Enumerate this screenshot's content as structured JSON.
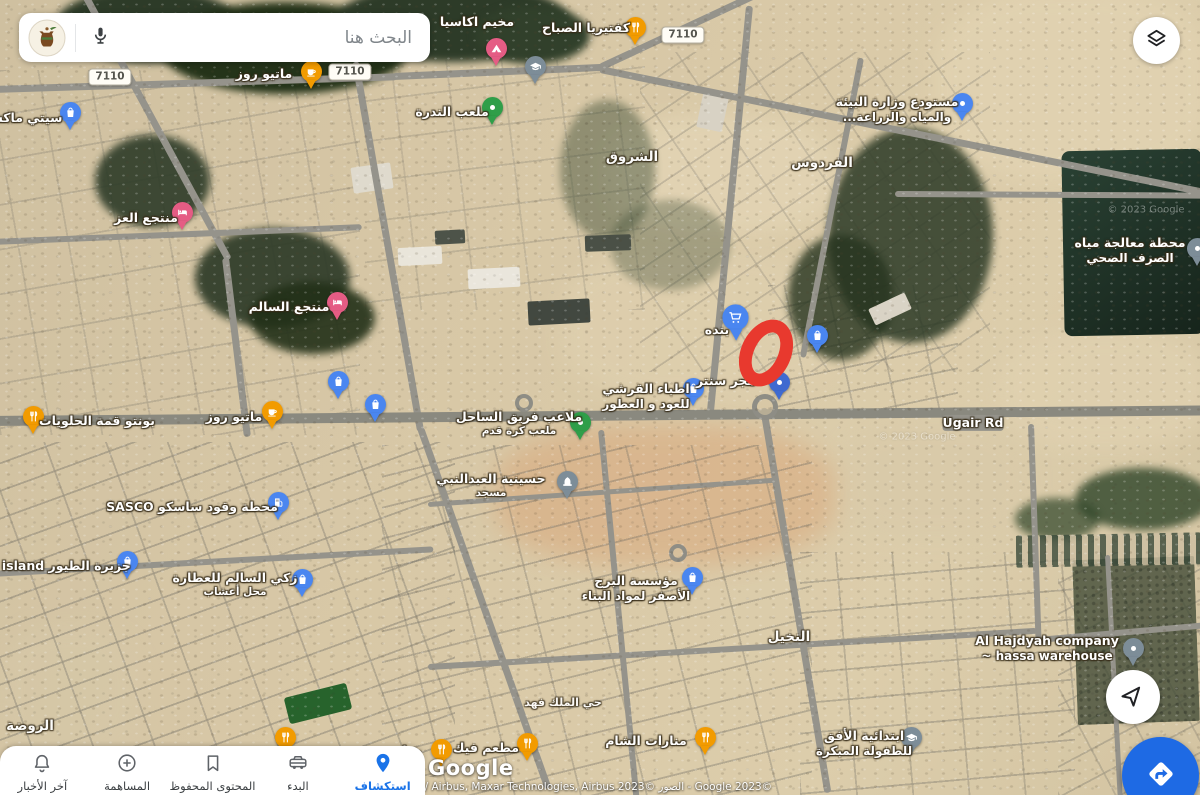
{
  "app": {
    "search": {
      "placeholder": "البحث هنا"
    },
    "bottom_nav": {
      "items": [
        {
          "id": "news",
          "label": "آخر الأخبار",
          "icon": "bell-icon",
          "active": false
        },
        {
          "id": "contribute",
          "label": "المساهمة",
          "icon": "plus-circle-icon",
          "active": false
        },
        {
          "id": "saved",
          "label": "المحتوى المحفوظ",
          "icon": "bookmark-icon",
          "active": false
        },
        {
          "id": "commute",
          "label": "البدء",
          "icon": "car-icon",
          "active": false
        },
        {
          "id": "explore",
          "label": "استكشاف",
          "icon": "location-pin-icon",
          "active": true
        }
      ]
    },
    "fabs": {
      "locate_icon": "navigation-arrow-icon",
      "directions_icon": "directions-icon"
    },
    "colors": {
      "active_blue": "#1a73e8",
      "fab_blue": "#1e6ae4",
      "annotation_red": "#e8392e",
      "pin_blue": "#4a86f0",
      "pin_orange": "#f29b00",
      "pin_pink": "#e55c84",
      "pin_green": "#2f9e49",
      "pin_gray": "#7d8d98"
    }
  },
  "map": {
    "attribution": {
      "logo": "Google",
      "copyright": "CNES / Airbus, Maxar Technologies, Airbus 2023© الصور - Google 2023©"
    },
    "road_badges": [
      {
        "text": "7110",
        "x": 110,
        "y": 77
      },
      {
        "text": "7110",
        "x": 350,
        "y": 72
      },
      {
        "text": "7110",
        "x": 683,
        "y": 35
      }
    ],
    "labels": [
      {
        "text": "مخيم اكاسيا",
        "x": 477,
        "y": 22
      },
      {
        "text": "كفتيريا الصباح",
        "x": 586,
        "y": 28
      },
      {
        "text": "ماتيو روز",
        "x": 264,
        "y": 74
      },
      {
        "text": "سيتي ماكس",
        "x": 24,
        "y": 118
      },
      {
        "text": "ملعب الندرة",
        "x": 452,
        "y": 112
      },
      {
        "text": "منتجع العز",
        "x": 146,
        "y": 218
      },
      {
        "text": "منتجع السالم",
        "x": 289,
        "y": 307
      },
      {
        "text": "الشروق",
        "x": 632,
        "y": 158,
        "kind": "district"
      },
      {
        "text": "الفردوس",
        "x": 822,
        "y": 164,
        "kind": "district"
      },
      {
        "text": "مستودع وزارة البيئة",
        "sub": "والمياه والزراعة...",
        "x": 897,
        "y": 110
      },
      {
        "text": "محطة معالجة مياه",
        "sub": "الصرف الصحي",
        "x": 1130,
        "y": 251
      },
      {
        "text": "بنده",
        "x": 717,
        "y": 330
      },
      {
        "text": "هجر سنتر",
        "x": 726,
        "y": 381
      },
      {
        "text": "اطباء القرشي",
        "sub": "للعود و العطور",
        "x": 646,
        "y": 397
      },
      {
        "text": "بونتو قمة الحلويات",
        "x": 97,
        "y": 421
      },
      {
        "text": "ماتيو روز",
        "x": 234,
        "y": 417
      },
      {
        "text": "Ugair Rd",
        "x": 973,
        "y": 423,
        "kind": "road"
      },
      {
        "text": "ملاعب فريق الساحل",
        "sub": "ملعب كرة قدم",
        "subsmall": true,
        "x": 519,
        "y": 424
      },
      {
        "text": "حسينية العبدالنبي",
        "sub": "مسجد",
        "subsmall": true,
        "x": 491,
        "y": 486
      },
      {
        "text": "محطة وقود ساسكو SASCO",
        "x": 192,
        "y": 507
      },
      {
        "text": "جزيرة الطيور bird island",
        "x": 50,
        "y": 566
      },
      {
        "text": "زكي السالم للعطارة",
        "sub": "محل أعشاب",
        "subsmall": true,
        "x": 235,
        "y": 585
      },
      {
        "text": "مؤسسة البرج",
        "sub": "الأصفر لمواد البناء",
        "x": 636,
        "y": 589
      },
      {
        "text": "النخيل",
        "x": 789,
        "y": 638,
        "kind": "district"
      },
      {
        "text": "Al Hajdyah company",
        "sub": "~ hassa warehouse",
        "x": 1047,
        "y": 649,
        "kind": "latin"
      },
      {
        "text": "الروضة",
        "x": 30,
        "y": 727,
        "kind": "district"
      },
      {
        "text": "حي الملك فهد",
        "x": 563,
        "y": 703,
        "kind": "district-sm"
      },
      {
        "text": "مطعم فيك",
        "x": 486,
        "y": 748
      },
      {
        "text": "منارات الشام",
        "x": 646,
        "y": 741
      },
      {
        "text": "ابتدائية الأفق",
        "sub": "للطفولة المبكرة",
        "x": 864,
        "y": 744
      },
      {
        "text": "مط",
        "x": 411,
        "y": 751
      },
      {
        "text": "© 2023 Google",
        "x": 917,
        "y": 437,
        "kind": "watermark"
      },
      {
        "text": "© 2023 Google",
        "x": 1146,
        "y": 210,
        "kind": "watermark"
      }
    ],
    "markers": [
      {
        "icon": "bag",
        "color": "#4a86f0",
        "x": 70,
        "y": 112
      },
      {
        "icon": "cup",
        "color": "#f29b00",
        "x": 311,
        "y": 71
      },
      {
        "icon": "bed",
        "color": "#e55c84",
        "x": 182,
        "y": 212
      },
      {
        "icon": "bed",
        "color": "#e55c84",
        "x": 337,
        "y": 302
      },
      {
        "icon": "fork",
        "color": "#f29b00",
        "x": 33,
        "y": 416
      },
      {
        "icon": "cup",
        "color": "#f29b00",
        "x": 272,
        "y": 411
      },
      {
        "icon": "bag",
        "color": "#4a86f0",
        "x": 338,
        "y": 381
      },
      {
        "icon": "bag",
        "color": "#4a86f0",
        "x": 375,
        "y": 404
      },
      {
        "icon": "fork",
        "color": "#f29b00",
        "x": 635,
        "y": 27
      },
      {
        "icon": "tent",
        "color": "#e55c84",
        "x": 496,
        "y": 48
      },
      {
        "icon": "cap",
        "color": "#7d8d98",
        "x": 535,
        "y": 66
      },
      {
        "icon": "dot",
        "color": "#2f9e49",
        "x": 492,
        "y": 107
      },
      {
        "icon": "dot",
        "color": "#4a86f0",
        "x": 962,
        "y": 103
      },
      {
        "icon": "cart",
        "color": "#4a86f0",
        "x": 735,
        "y": 317,
        "s": 1.25
      },
      {
        "icon": "bag",
        "color": "#4a86f0",
        "x": 817,
        "y": 335
      },
      {
        "icon": "bag",
        "color": "#4a86f0",
        "x": 693,
        "y": 388
      },
      {
        "icon": "dot",
        "color": "#3f6ad0",
        "x": 779,
        "y": 382
      },
      {
        "icon": "dot",
        "color": "#2f9e49",
        "x": 580,
        "y": 422
      },
      {
        "icon": "dome",
        "color": "#7d8d98",
        "x": 567,
        "y": 481
      },
      {
        "icon": "fuel",
        "color": "#4a86f0",
        "x": 278,
        "y": 502
      },
      {
        "icon": "bag",
        "color": "#4a86f0",
        "x": 127,
        "y": 561
      },
      {
        "icon": "bag",
        "color": "#4a86f0",
        "x": 302,
        "y": 579
      },
      {
        "icon": "bag",
        "color": "#4a86f0",
        "x": 692,
        "y": 577
      },
      {
        "icon": "dot",
        "color": "#7d8d98",
        "x": 1133,
        "y": 648
      },
      {
        "icon": "fork",
        "color": "#f29b00",
        "x": 285,
        "y": 737
      },
      {
        "icon": "fork",
        "color": "#f29b00",
        "x": 441,
        "y": 749
      },
      {
        "icon": "fork",
        "color": "#f29b00",
        "x": 527,
        "y": 743
      },
      {
        "icon": "fork",
        "color": "#f29b00",
        "x": 705,
        "y": 737
      },
      {
        "icon": "cap",
        "color": "#7d8d98",
        "x": 911,
        "y": 737
      },
      {
        "icon": "dot",
        "color": "#7d8d98",
        "x": 1197,
        "y": 248
      }
    ],
    "annotation": {
      "shape": "ellipse",
      "color": "#e8392e",
      "x": 766,
      "y": 353,
      "rx": 25,
      "ry": 35,
      "stroke": 13,
      "rot": 25
    }
  }
}
